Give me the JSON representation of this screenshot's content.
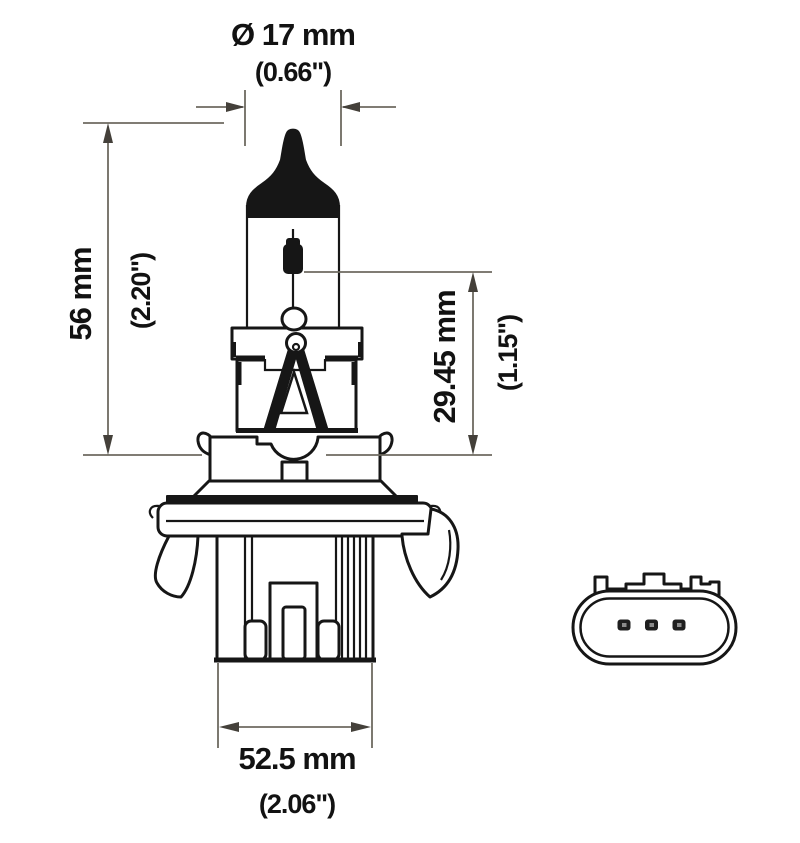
{
  "colors": {
    "background": "#ffffff",
    "drawing_line": "#161616",
    "dimension_line": "#6e6a60",
    "text": "#121212"
  },
  "dimensions": {
    "diameter": {
      "metric": "Ø 17 mm",
      "imperial": "(0.66\")"
    },
    "overall_length": {
      "metric": "56 mm",
      "imperial": "(2.20\")"
    },
    "filament_height": {
      "metric": "29.45 mm",
      "imperial": "(1.15\")"
    },
    "base_width": {
      "metric": "52.5 mm",
      "imperial": "(2.06\")"
    }
  }
}
